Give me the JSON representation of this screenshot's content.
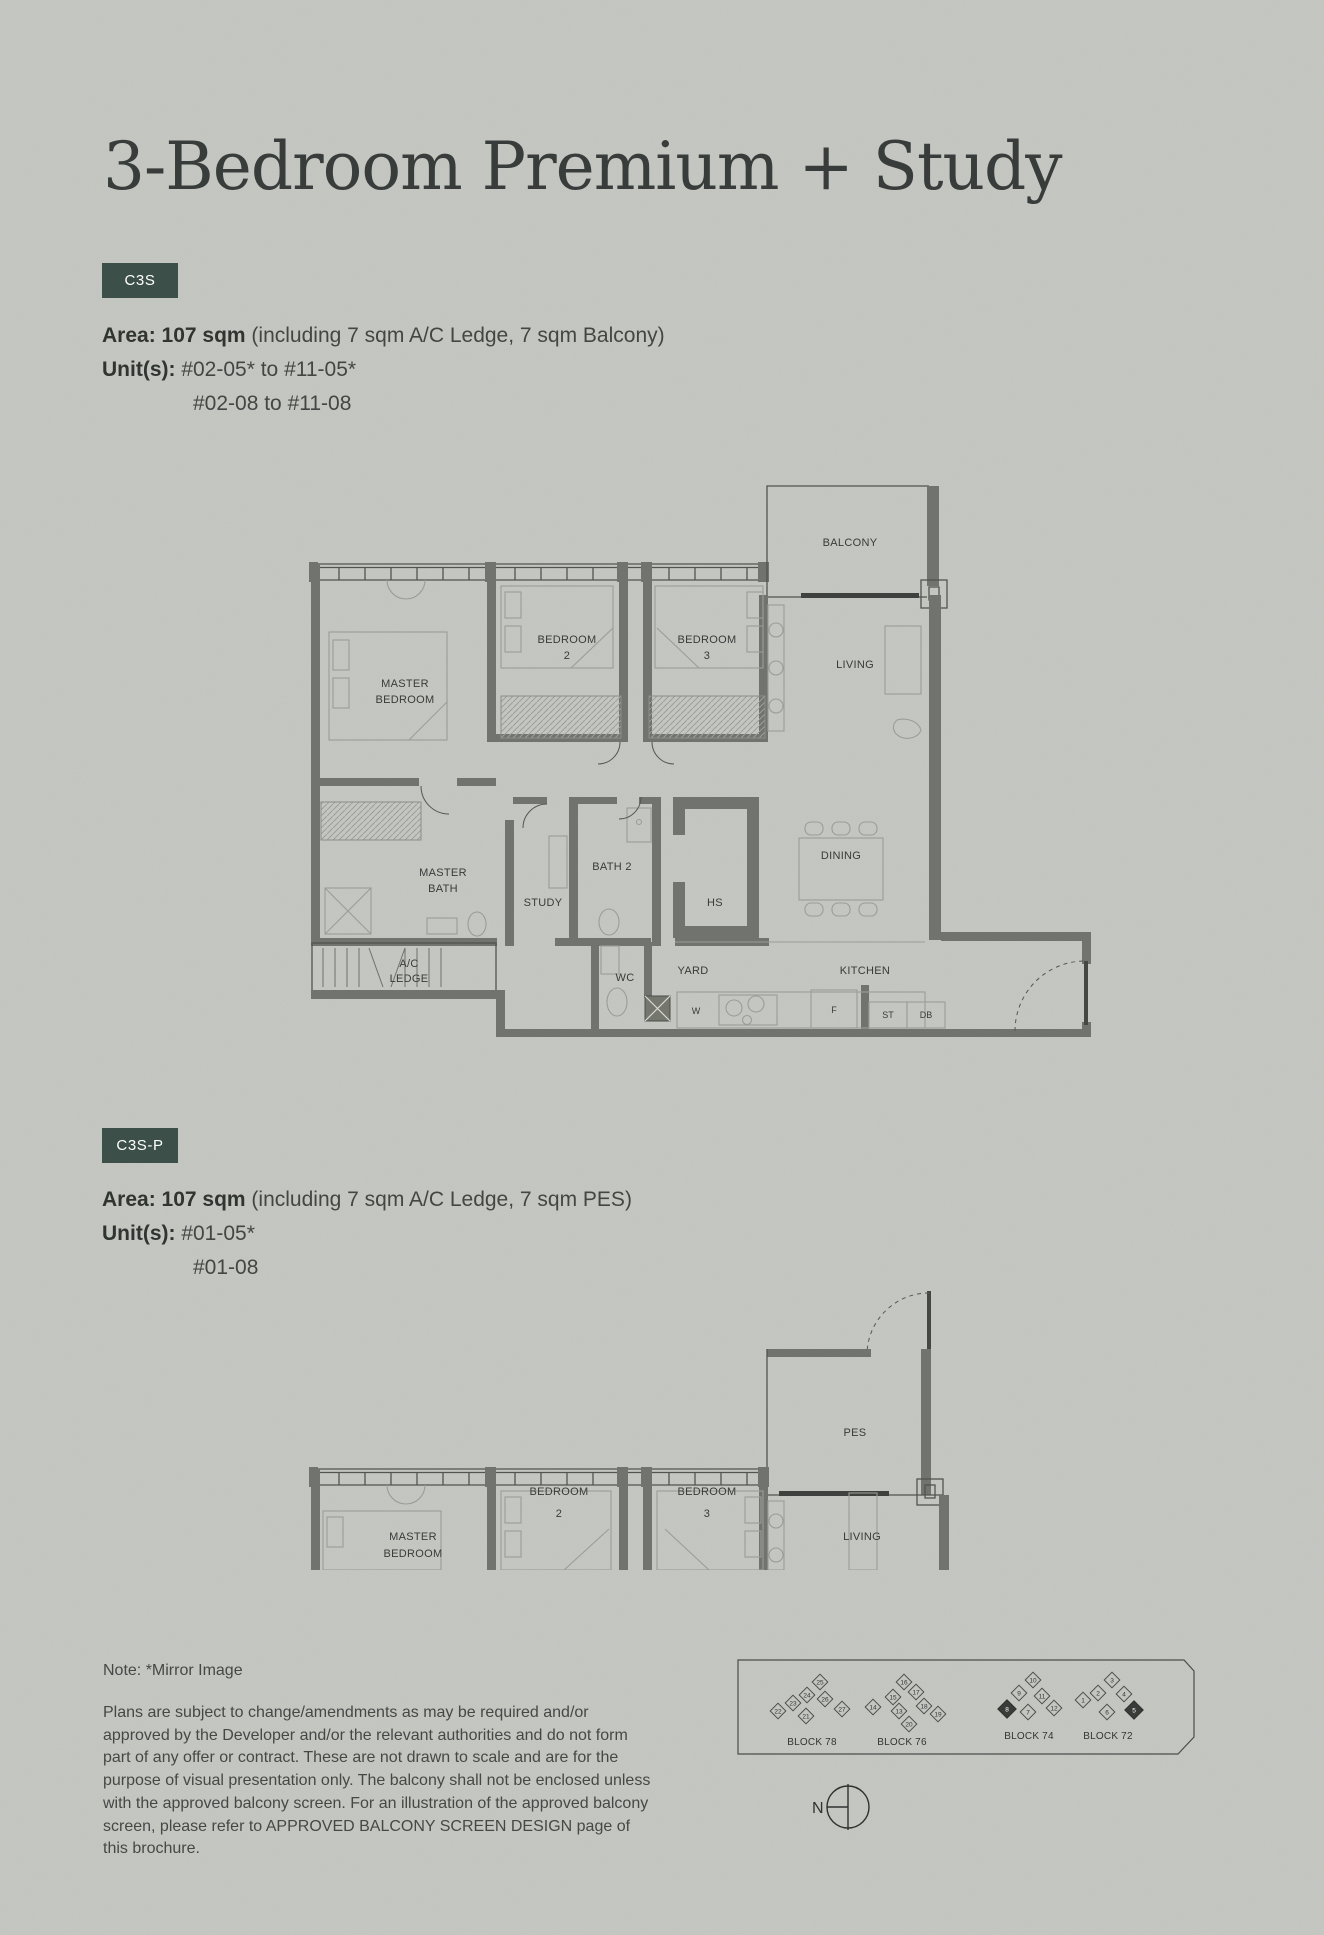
{
  "page": {
    "title": "3-Bedroom Premium + Study",
    "note": "Note: *Mirror Image",
    "disclaimer": "Plans are subject to change/amendments as may be required and/or approved by the Developer and/or the relevant authorities and do not form part of any offer or contract. These are not drawn to scale and are for the purpose of visual presentation only. The balcony shall not be enclosed unless with the approved balcony screen. For an illustration of the approved balcony screen, please refer to APPROVED BALCONY SCREEN DESIGN page of this brochure."
  },
  "colors": {
    "background": "#c4c6c1",
    "badge_bg": "#3c5049",
    "badge_text": "#ffffff",
    "wall_gray": "#71736e",
    "title_gray": "#383d3b"
  },
  "variant1": {
    "code": "C3S",
    "area_bold": "Area: 107 sqm",
    "area_rest": " (including 7 sqm A/C Ledge, 7 sqm Balcony)",
    "units_label": "Unit(s):",
    "units_line1": "#02-05* to #11-05*",
    "units_line2": "#02-08 to #11-08"
  },
  "variant2": {
    "code": "C3S-P",
    "area_bold": "Area: 107 sqm",
    "area_rest": " (including 7 sqm A/C Ledge, 7 sqm PES)",
    "units_label": "Unit(s):",
    "units_line1": "#01-05*",
    "units_line2": "#01-08"
  },
  "plan1": {
    "balcony": "BALCONY",
    "master1": "MASTER",
    "master2": "BEDROOM",
    "bed2a": "BEDROOM",
    "bed2b": "2",
    "bed3a": "BEDROOM",
    "bed3b": "3",
    "living": "LIVING",
    "mbath1": "MASTER",
    "mbath2": "BATH",
    "study": "STUDY",
    "bath2": "BATH 2",
    "hs": "HS",
    "dining": "DINING",
    "ac1": "A/C",
    "ac2": "LEDGE",
    "wc": "WC",
    "yard": "YARD",
    "kitchen": "KITCHEN",
    "w": "W",
    "f": "F",
    "st": "ST",
    "db": "DB"
  },
  "plan2": {
    "pes": "PES",
    "master1": "MASTER",
    "master2": "BEDROOM",
    "bed2a": "BEDROOM",
    "bed2b": "2",
    "bed3a": "BEDROOM",
    "bed3b": "3",
    "living": "LIVING"
  },
  "sitekey": {
    "north_label": "N",
    "blocks": [
      {
        "label": "BLOCK 78",
        "units": [
          "25",
          "24",
          "23",
          "22",
          "26",
          "27",
          "21"
        ]
      },
      {
        "label": "BLOCK 76",
        "units": [
          "16",
          "15",
          "14",
          "17",
          "18",
          "13",
          "20",
          "19"
        ]
      },
      {
        "label": "BLOCK 74",
        "units": [
          "10",
          "9",
          "11",
          "12",
          "7",
          "8"
        ]
      },
      {
        "label": "BLOCK 72",
        "units": [
          "3",
          "2",
          "4",
          "1",
          "6",
          "5"
        ]
      }
    ]
  }
}
